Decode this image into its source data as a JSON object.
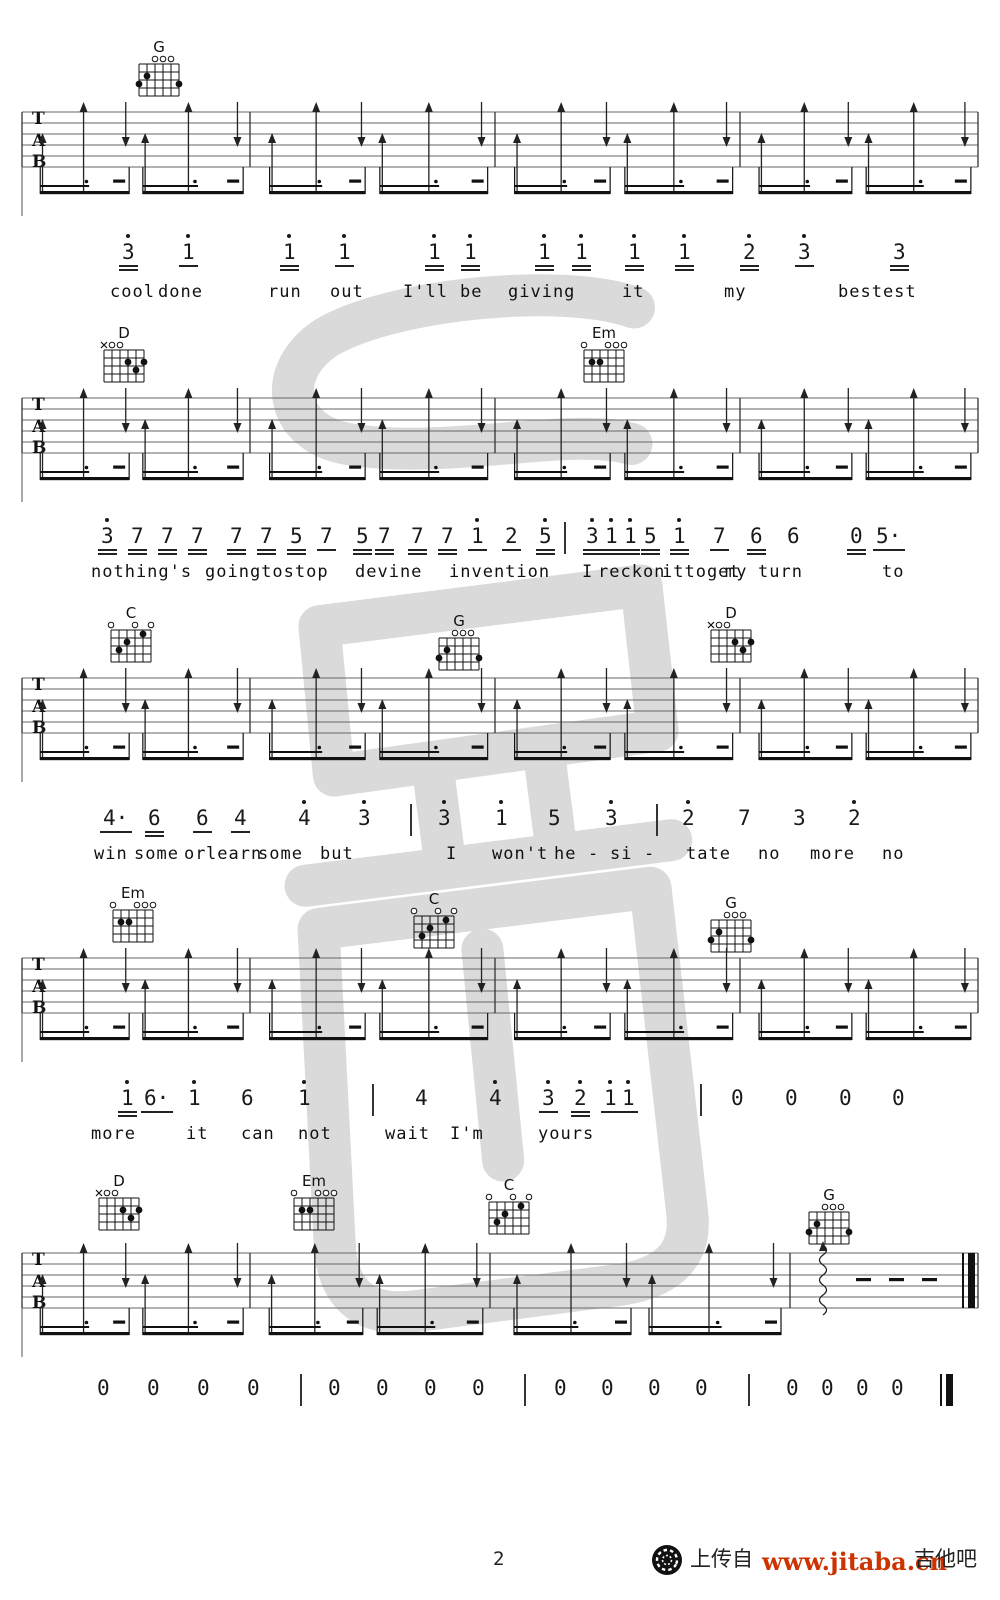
{
  "footer": {
    "page_number": "2",
    "upload_text": "上传自",
    "site_url": "www.jitaba.cn",
    "site_name": "吉他吧",
    "url_color": "#cc3300"
  },
  "watermark": {
    "color": "#dadada"
  },
  "tab_letters": [
    "T",
    "A",
    "B"
  ],
  "strum": {
    "pattern": [
      {
        "p": 0.09,
        "t": "su"
      },
      {
        "p": 0.27,
        "t": "tu"
      },
      {
        "p": 0.455,
        "t": "d"
      },
      {
        "p": 0.54,
        "t": "su"
      },
      {
        "p": 0.73,
        "t": "tu"
      },
      {
        "p": 0.945,
        "t": "d"
      }
    ],
    "beams": [
      [
        0.08,
        0.47
      ],
      [
        0.53,
        0.97
      ]
    ]
  },
  "chord_shapes": {
    "G": {
      "marks": [
        "",
        "",
        "o",
        "o",
        "o",
        ""
      ],
      "dots": [
        [
          1,
          3
        ],
        [
          2,
          2
        ],
        [
          6,
          3
        ]
      ]
    },
    "D": {
      "marks": [
        "x",
        "o",
        "o",
        "",
        "",
        ""
      ],
      "dots": [
        [
          4,
          2
        ],
        [
          5,
          3
        ],
        [
          6,
          2
        ]
      ]
    },
    "Em": {
      "marks": [
        "o",
        "",
        "",
        "o",
        "o",
        "o"
      ],
      "dots": [
        [
          2,
          2
        ],
        [
          3,
          2
        ]
      ]
    },
    "C": {
      "marks": [
        "o",
        "",
        "",
        "o",
        "",
        "o"
      ],
      "dots": [
        [
          2,
          3
        ],
        [
          3,
          2
        ],
        [
          5,
          1
        ]
      ]
    }
  },
  "systems": [
    {
      "chord_y": 40,
      "staff_y": 112,
      "melody_y": 242,
      "lyric_y": 284,
      "barlines": [
        22,
        250,
        495,
        740,
        978
      ],
      "chords": [
        {
          "name": "G",
          "x": 136
        }
      ],
      "notes": [
        {
          "n": "3",
          "o": 1,
          "u": 2,
          "x": 122
        },
        {
          "n": "1",
          "o": 1,
          "u": 1,
          "x": 182
        },
        {
          "n": "1",
          "o": 1,
          "u": 2,
          "x": 283
        },
        {
          "n": "1",
          "o": 1,
          "u": 1,
          "x": 338
        },
        {
          "n": "1",
          "o": 1,
          "u": 2,
          "x": 428
        },
        {
          "n": "1",
          "o": 1,
          "u": 2,
          "x": 464
        },
        {
          "n": "1",
          "o": 1,
          "u": 2,
          "x": 538
        },
        {
          "n": "1",
          "o": 1,
          "u": 2,
          "x": 575
        },
        {
          "n": "1",
          "o": 1,
          "u": 2,
          "x": 628
        },
        {
          "n": "1",
          "o": 1,
          "u": 2,
          "x": 678
        },
        {
          "n": "2",
          "o": 1,
          "u": 2,
          "x": 743
        },
        {
          "n": "3",
          "o": 1,
          "u": 1,
          "x": 798
        },
        {
          "n": "3",
          "o": 0,
          "u": 2,
          "x": 893
        }
      ],
      "lyrics": [
        {
          "t": "cool",
          "x": 110
        },
        {
          "t": "done",
          "x": 158
        },
        {
          "t": "run",
          "x": 268
        },
        {
          "t": "out",
          "x": 330
        },
        {
          "t": "I'll",
          "x": 403
        },
        {
          "t": "be",
          "x": 460
        },
        {
          "t": "giving",
          "x": 508
        },
        {
          "t": "it",
          "x": 622
        },
        {
          "t": "my",
          "x": 724
        },
        {
          "t": "bestest",
          "x": 838
        }
      ]
    },
    {
      "chord_y": 326,
      "staff_y": 398,
      "melody_y": 526,
      "lyric_y": 564,
      "barlines": [
        22,
        250,
        495,
        740,
        978
      ],
      "chords": [
        {
          "name": "D",
          "x": 101
        },
        {
          "name": "Em",
          "x": 581
        }
      ],
      "notes": [
        {
          "n": "3",
          "o": 1,
          "u": 2,
          "x": 101
        },
        {
          "n": "7",
          "o": 0,
          "u": 2,
          "x": 131
        },
        {
          "n": "7",
          "o": 0,
          "u": 2,
          "x": 161
        },
        {
          "n": "7",
          "o": 0,
          "u": 2,
          "x": 191
        },
        {
          "n": "7",
          "o": 0,
          "u": 2,
          "x": 230
        },
        {
          "n": "7",
          "o": 0,
          "u": 2,
          "x": 260
        },
        {
          "n": "5",
          "o": 0,
          "u": 2,
          "x": 290
        },
        {
          "n": "7",
          "o": 0,
          "u": 1,
          "x": 320
        },
        {
          "n": "5",
          "o": 0,
          "u": 2,
          "x": 356
        },
        {
          "n": "7",
          "o": 0,
          "u": 2,
          "x": 378
        },
        {
          "n": "7",
          "o": 0,
          "u": 2,
          "x": 411
        },
        {
          "n": "7",
          "o": 0,
          "u": 2,
          "x": 441
        },
        {
          "n": "1",
          "o": 1,
          "u": 1,
          "x": 471
        },
        {
          "n": "2",
          "o": 0,
          "u": 1,
          "x": 505
        },
        {
          "n": "5",
          "o": 1,
          "u": 2,
          "x": 539
        },
        {
          "n": "|",
          "x": 564
        },
        {
          "n": "3",
          "o": 1,
          "u": 2,
          "x": 586
        },
        {
          "n": "1",
          "o": 1,
          "u": 2,
          "x": 605
        },
        {
          "n": "1",
          "o": 1,
          "u": 2,
          "x": 624
        },
        {
          "n": "5",
          "o": 0,
          "u": 2,
          "x": 644
        },
        {
          "n": "1",
          "o": 1,
          "u": 2,
          "x": 673
        },
        {
          "n": "7",
          "o": 0,
          "u": 1,
          "x": 713
        },
        {
          "n": "6",
          "o": 0,
          "u": 2,
          "x": 750
        },
        {
          "n": "6",
          "o": 0,
          "u": 0,
          "x": 787
        },
        {
          "n": "0",
          "o": 0,
          "u": 2,
          "x": 850
        },
        {
          "n": "5·",
          "o": 0,
          "u": 1,
          "x": 876
        }
      ],
      "lyrics": [
        {
          "t": "nothing's",
          "x": 91
        },
        {
          "t": "goingtostop",
          "x": 205
        },
        {
          "t": "devine",
          "x": 355
        },
        {
          "t": "invention",
          "x": 449
        },
        {
          "t": "I",
          "x": 582
        },
        {
          "t": "reckon",
          "x": 598
        },
        {
          "t": "ittoget",
          "x": 662
        },
        {
          "t": "my",
          "x": 725
        },
        {
          "t": "turn",
          "x": 758
        },
        {
          "t": "to",
          "x": 882
        }
      ]
    },
    {
      "chord_y": 606,
      "staff_y": 678,
      "melody_y": 808,
      "lyric_y": 846,
      "barlines": [
        22,
        250,
        495,
        740,
        978
      ],
      "chords": [
        {
          "name": "C",
          "x": 108
        },
        {
          "name": "G",
          "x": 436,
          "dy": 8
        },
        {
          "name": "D",
          "x": 708
        }
      ],
      "notes": [
        {
          "n": "4·",
          "o": 0,
          "u": 1,
          "x": 103
        },
        {
          "n": "6",
          "o": 0,
          "u": 2,
          "x": 148
        },
        {
          "n": "6",
          "o": 0,
          "u": 1,
          "x": 196
        },
        {
          "n": "4",
          "o": 0,
          "u": 1,
          "x": 234
        },
        {
          "n": "4",
          "o": 1,
          "u": 0,
          "x": 298
        },
        {
          "n": "3",
          "o": 1,
          "u": 0,
          "x": 358
        },
        {
          "n": "|",
          "x": 410
        },
        {
          "n": "3",
          "o": 1,
          "u": 0,
          "x": 438
        },
        {
          "n": "1",
          "o": 1,
          "u": 0,
          "x": 495
        },
        {
          "n": "5",
          "o": 0,
          "u": 0,
          "x": 548
        },
        {
          "n": "3",
          "o": 1,
          "u": 0,
          "x": 605
        },
        {
          "n": "|",
          "x": 656
        },
        {
          "n": "2",
          "o": 1,
          "u": 0,
          "x": 682
        },
        {
          "n": "7",
          "o": 0,
          "u": 0,
          "x": 738
        },
        {
          "n": "3",
          "o": 0,
          "u": 0,
          "x": 793
        },
        {
          "n": "2",
          "o": 1,
          "u": 0,
          "x": 848
        }
      ],
      "lyrics": [
        {
          "t": "win",
          "x": 94
        },
        {
          "t": "some",
          "x": 134
        },
        {
          "t": "or",
          "x": 184
        },
        {
          "t": "learn",
          "x": 206
        },
        {
          "t": "some",
          "x": 258
        },
        {
          "t": "but",
          "x": 320
        },
        {
          "t": "I",
          "x": 446
        },
        {
          "t": "won't",
          "x": 492
        },
        {
          "t": "he",
          "x": 554
        },
        {
          "t": "-",
          "x": 588
        },
        {
          "t": "si",
          "x": 610
        },
        {
          "t": "-",
          "x": 644
        },
        {
          "t": "tate",
          "x": 686
        },
        {
          "t": "no",
          "x": 758
        },
        {
          "t": "more",
          "x": 810
        },
        {
          "t": "no",
          "x": 882
        }
      ]
    },
    {
      "chord_y": 886,
      "staff_y": 958,
      "melody_y": 1088,
      "lyric_y": 1126,
      "barlines": [
        22,
        250,
        495,
        740,
        978
      ],
      "chords": [
        {
          "name": "Em",
          "x": 110
        },
        {
          "name": "C",
          "x": 411,
          "dy": 6
        },
        {
          "name": "G",
          "x": 708,
          "dy": 10
        }
      ],
      "notes": [
        {
          "n": "1",
          "o": 1,
          "u": 2,
          "x": 121
        },
        {
          "n": "6·",
          "o": 0,
          "u": 1,
          "x": 144
        },
        {
          "n": "1",
          "o": 1,
          "u": 0,
          "x": 188
        },
        {
          "n": "6",
          "o": 0,
          "u": 0,
          "x": 241
        },
        {
          "n": "1",
          "o": 1,
          "u": 0,
          "x": 298
        },
        {
          "n": "|",
          "x": 372
        },
        {
          "n": "4",
          "o": 0,
          "u": 0,
          "x": 415
        },
        {
          "n": "4",
          "o": 1,
          "u": 0,
          "x": 489
        },
        {
          "n": "3",
          "o": 1,
          "u": 1,
          "x": 542
        },
        {
          "n": "2",
          "o": 1,
          "u": 2,
          "x": 574
        },
        {
          "n": "1",
          "o": 1,
          "u": 1,
          "x": 604
        },
        {
          "n": "1",
          "o": 1,
          "u": 1,
          "x": 622
        },
        {
          "n": "|",
          "x": 700
        },
        {
          "n": "0",
          "o": 0,
          "u": 0,
          "x": 731
        },
        {
          "n": "0",
          "o": 0,
          "u": 0,
          "x": 785
        },
        {
          "n": "0",
          "o": 0,
          "u": 0,
          "x": 839
        },
        {
          "n": "0",
          "o": 0,
          "u": 0,
          "x": 892
        }
      ],
      "lyrics": [
        {
          "t": "more",
          "x": 91
        },
        {
          "t": "it",
          "x": 186
        },
        {
          "t": "can",
          "x": 241
        },
        {
          "t": "not",
          "x": 298
        },
        {
          "t": "wait",
          "x": 385
        },
        {
          "t": "I'm",
          "x": 450
        },
        {
          "t": "yours",
          "x": 538
        }
      ]
    },
    {
      "chord_y": 1174,
      "staff_y": 1253,
      "melody_y": 1378,
      "lyric_y": null,
      "barlines": [
        22,
        250,
        490,
        790,
        978
      ],
      "strum_measures": 3,
      "ending": {
        "wavy_x": 823,
        "dashes_x": [
          856,
          889,
          922
        ],
        "double_bar_x": 962
      },
      "chords": [
        {
          "name": "D",
          "x": 96
        },
        {
          "name": "Em",
          "x": 291
        },
        {
          "name": "C",
          "x": 486,
          "dy": 4
        },
        {
          "name": "G",
          "x": 806,
          "dy": 14
        }
      ],
      "notes": [
        {
          "n": "0",
          "x": 97
        },
        {
          "n": "0",
          "x": 147
        },
        {
          "n": "0",
          "x": 197
        },
        {
          "n": "0",
          "x": 247
        },
        {
          "n": "|",
          "x": 300
        },
        {
          "n": "0",
          "x": 328
        },
        {
          "n": "0",
          "x": 376
        },
        {
          "n": "0",
          "x": 424
        },
        {
          "n": "0",
          "x": 472
        },
        {
          "n": "|",
          "x": 524
        },
        {
          "n": "0",
          "x": 554
        },
        {
          "n": "0",
          "x": 601
        },
        {
          "n": "0",
          "x": 648
        },
        {
          "n": "0",
          "x": 695
        },
        {
          "n": "|",
          "x": 748
        },
        {
          "n": "0",
          "x": 786
        },
        {
          "n": "0",
          "x": 821
        },
        {
          "n": "0",
          "x": 856
        },
        {
          "n": "0",
          "x": 891
        },
        {
          "n": "||",
          "x": 940
        }
      ],
      "lyrics": []
    }
  ]
}
